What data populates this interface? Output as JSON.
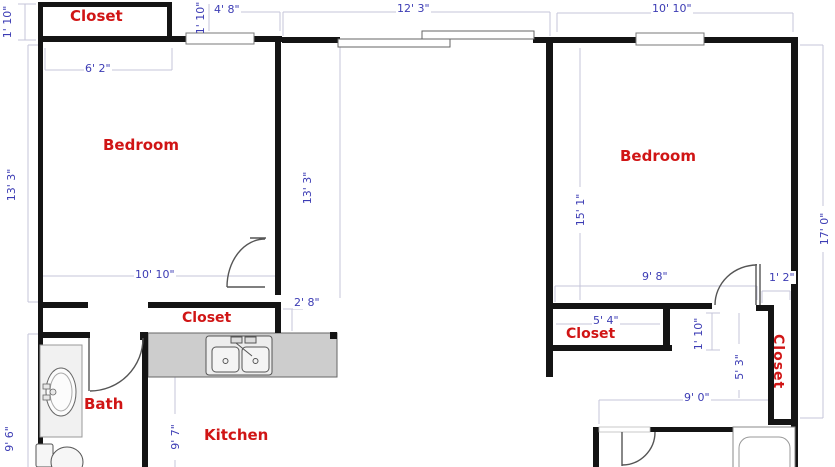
{
  "canvas": {
    "width": 835,
    "height": 467,
    "background": "#ffffff"
  },
  "colors": {
    "wall": "#141414",
    "room_label": "#d01515",
    "dimension_text": "#3c3cb4",
    "dimension_line": "#c4c4da",
    "counter_fill": "#cdcdcd",
    "fixture_stroke": "#555555"
  },
  "rooms": {
    "closet_tl": "Closet",
    "bedroom_left": "Bedroom",
    "bedroom_right": "Bedroom",
    "closet_hall": "Closet",
    "closet_bedroom_right": "Closet",
    "closet_right": "Closet",
    "bath": "Bath",
    "kitchen": "Kitchen"
  },
  "dims": {
    "closet_tl_depth": "1' 10\"",
    "tl_window_offset": "1' 10\"",
    "tl_window_width": "4' 8\"",
    "closet_tl_width": "6' 2\"",
    "living_top_width": "12' 3\"",
    "bedroom_right_top_width": "10' 10\"",
    "bedroom_left_height": "13' 3\"",
    "living_height": "13' 3\"",
    "bedroom_left_width": "10' 10\"",
    "hall_opening": "2' 8\"",
    "bedroom_right_height": "15' 1\"",
    "right_side_height": "17' 0\"",
    "bedroom_right_bottom_width": "9' 8\"",
    "door_offset": "1' 2\"",
    "closet_br_width": "5' 4\"",
    "closet_br_depth": "1' 10\"",
    "hall_right_height": "5' 3\"",
    "bath2_width": "9' 0\"",
    "kitchen_height": "9' 7\"",
    "bath_height": "9' 6\""
  }
}
